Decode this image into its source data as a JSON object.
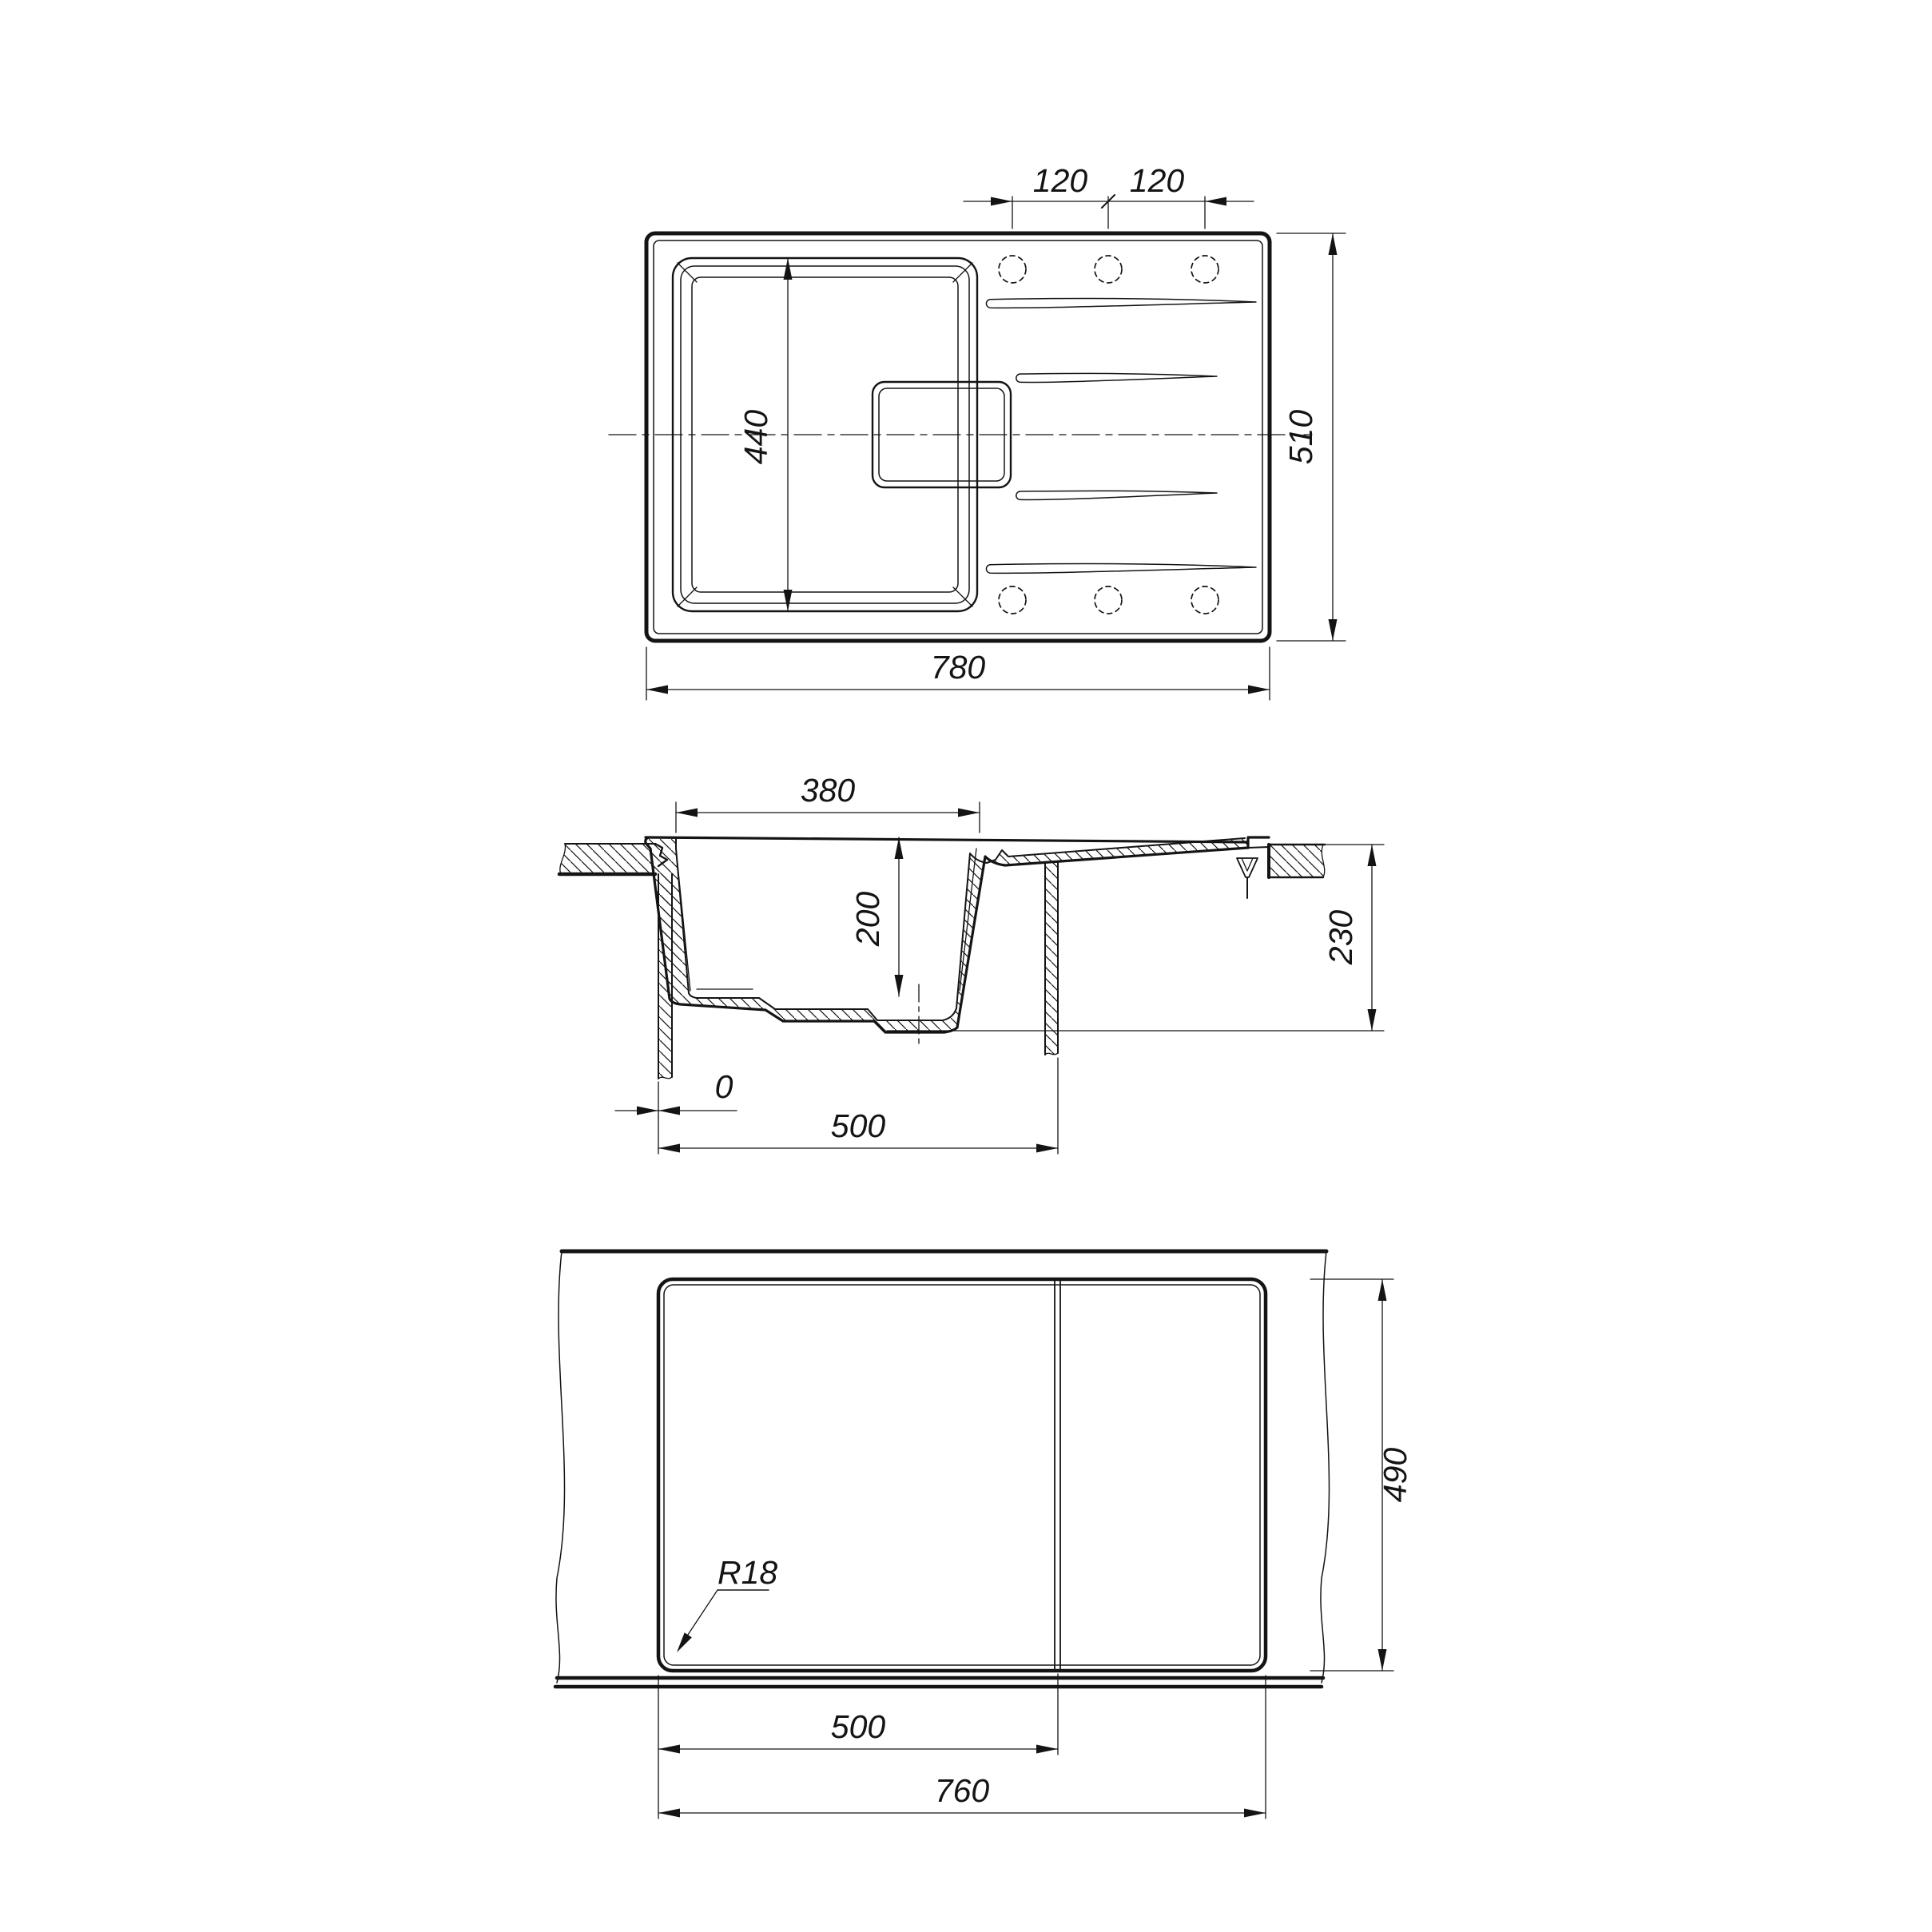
{
  "drawing": {
    "top_view": {
      "hole_spacing_left": "120",
      "hole_spacing_right": "120",
      "overall_width": "780",
      "overall_depth": "510",
      "bowl_length_plan": "440"
    },
    "section_view": {
      "bowl_opening_width": "380",
      "bowl_depth": "200",
      "overall_height": "230",
      "front_offset": "0",
      "cabinet_width": "500"
    },
    "cutout_view": {
      "cutout_depth": "490",
      "bowl_section_width": "500",
      "cutout_width": "760",
      "corner_radius": "R18"
    },
    "colors": {
      "line": "#141414",
      "background": "#ffffff"
    }
  }
}
